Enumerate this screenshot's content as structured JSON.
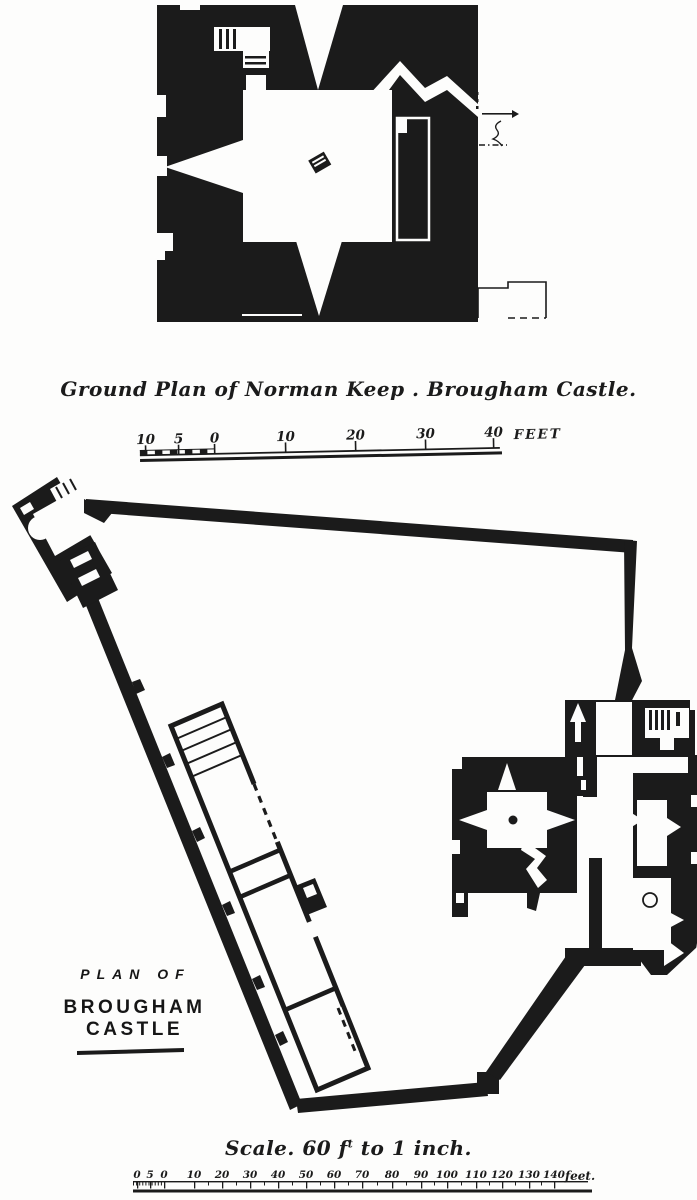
{
  "colors": {
    "ink": "#1b1b1b",
    "paper": "#fdfdfc"
  },
  "keep_plan": {
    "caption": "Ground Plan of Norman Keep . Brougham Castle."
  },
  "keep_scale": {
    "labels": [
      "10",
      "5",
      "0",
      "10",
      "20",
      "30",
      "40"
    ],
    "unit_label": "FEET"
  },
  "castle_plan": {
    "title_line_1": "PLAN OF",
    "title_line_2": "BROUGHAM CASTLE"
  },
  "castle_scale": {
    "caption_prefix": "Scale. 60 f",
    "caption_superscript": "t",
    "caption_suffix": " to 1 inch.",
    "labels": [
      "0",
      "5",
      "0",
      "10",
      "20",
      "30",
      "40",
      "50",
      "60",
      "70",
      "80",
      "90",
      "100",
      "110",
      "120",
      "130",
      "140"
    ],
    "unit_label": "feet."
  }
}
